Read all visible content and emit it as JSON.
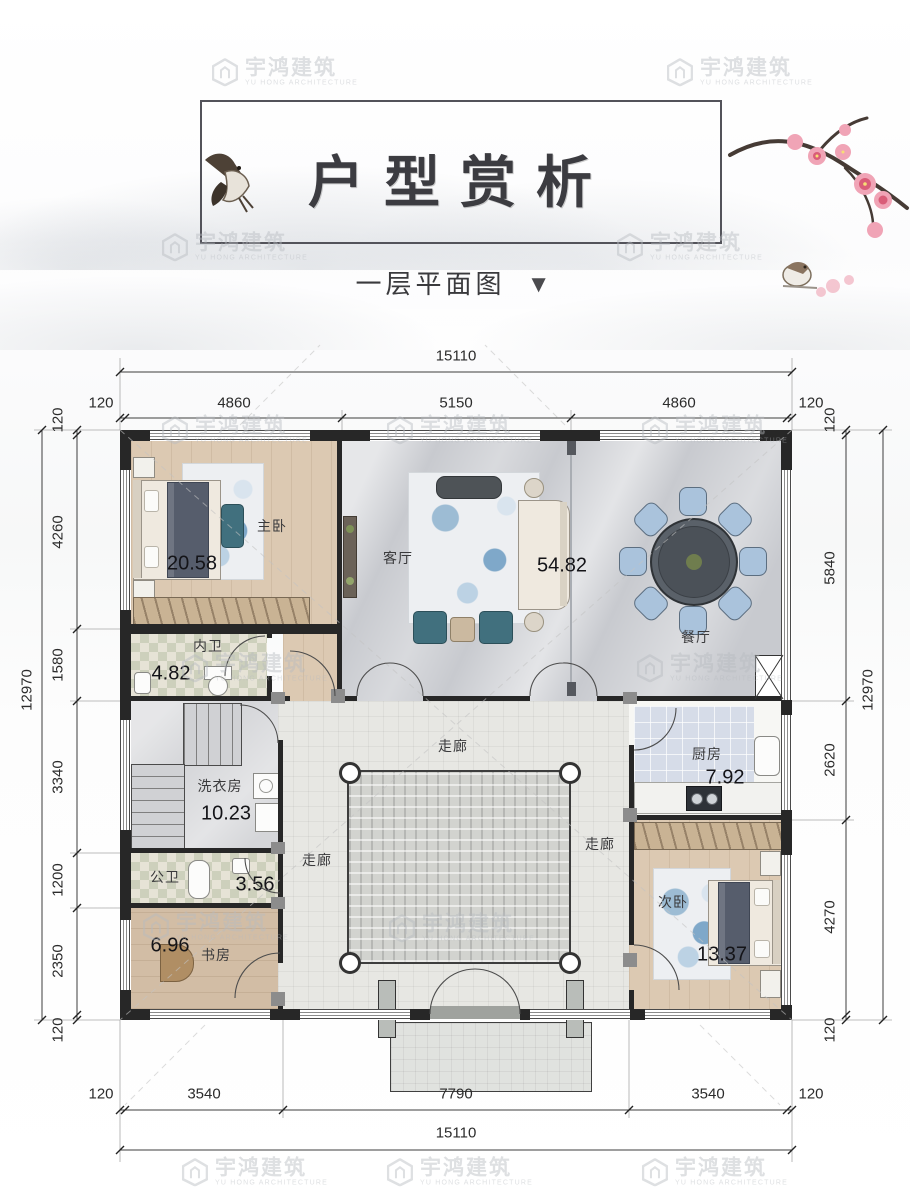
{
  "header": {
    "title": "户型赏析",
    "subtitle": "一层平面图",
    "subtitle_marker": "▼"
  },
  "watermark": {
    "brand": "宇鸿建筑",
    "sub": "YU HONG ARCHITECTURE"
  },
  "plan": {
    "rooms": {
      "master_bedroom": {
        "name": "主卧",
        "area": "20.58"
      },
      "living_room": {
        "name": "客厅",
        "area": "54.82"
      },
      "dining_room": {
        "name": "餐厅"
      },
      "inner_bath": {
        "name": "内卫",
        "area": "4.82"
      },
      "laundry": {
        "name": "洗衣房",
        "area": "10.23"
      },
      "public_bath": {
        "name": "公卫",
        "area": "3.56"
      },
      "study": {
        "name": "书房",
        "area": "6.96"
      },
      "kitchen": {
        "name": "厨房",
        "area": "7.92"
      },
      "second_bedroom": {
        "name": "次卧",
        "area": "13.37"
      },
      "corridor_top": {
        "name": "走廊"
      },
      "corridor_left": {
        "name": "走廊"
      },
      "corridor_right": {
        "name": "走廊"
      }
    },
    "dimensions": {
      "top": {
        "total": "15110",
        "segments": [
          "120",
          "4860",
          "5150",
          "4860",
          "120"
        ]
      },
      "bottom": {
        "total": "15110",
        "segments": [
          "120",
          "3540",
          "7790",
          "3540",
          "120"
        ]
      },
      "left": {
        "total": "12970",
        "segments": [
          "120",
          "4260",
          "1580",
          "3340",
          "1200",
          "2350",
          "120"
        ]
      },
      "right": {
        "total": "12970",
        "segments": [
          "120",
          "5840",
          "2620",
          "4270",
          "120"
        ]
      }
    }
  },
  "colors": {
    "wall": "#272727",
    "wood_floor": "#dcc9b2",
    "marble_floor": "#c8cacf",
    "kitchen_tile": "#d6dce8",
    "dining_chair": "#aac3dc",
    "blossom_pink": "#e98ba2"
  }
}
